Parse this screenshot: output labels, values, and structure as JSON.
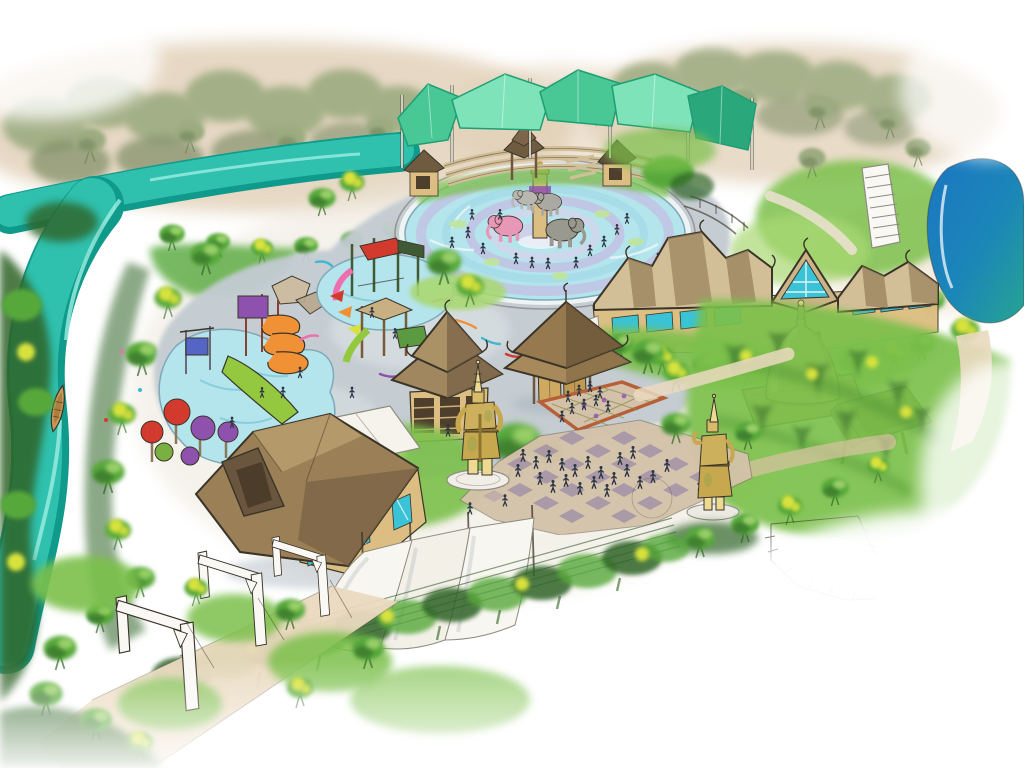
{
  "scene": {
    "kind": "watercolor concept rendering",
    "subject": "Aerial watercolor concept rendering of a Thai-themed elephant water playground park",
    "aria_label": "Hand-drawn aerial watercolor rendering: Thai-themed water playground with elephant splash fountain, shade canopy amphitheater, slide pools, Thai pavilions, golden stupa, two golden guardian statues, checkerboard plaza, lazy river with wooden boat, pond and tree-lined paths"
  },
  "features": {
    "canopy": "teal shade-sail canopy over amphitheater seating",
    "splash_pool": "circular elephant splash fountain pool",
    "kids_pools": "children's splash pools with slides and play structures",
    "river": "lazy river",
    "boat": "wooden boat",
    "pond": "pond",
    "stairs": "hillside staircase",
    "pavilion_small": "small Thai pavilion",
    "pavilion_gate": "Thai gate pavilion",
    "main_building": "main Thai building complex",
    "stupa": "golden stupa shrine",
    "statue_front": "golden yaksha guardian statue (front)",
    "statue_back": "golden yaksha guardian statue (rear)",
    "plaza": "checkerboard plaza with visitors",
    "pergolas": "white gateway pergolas over path",
    "sails": "white shade sails",
    "fence": "vine-covered cable fence",
    "lawn": "terraced lawns with survey marks"
  },
  "palette": {
    "paper": "#ffffff",
    "sand": "#d9c3a3",
    "sand_light": "#ead9bf",
    "deck": "#c2cbd1",
    "deck_light": "#dde3e5",
    "river": "#2fc0ae",
    "river_deep": "#0f9a8b",
    "river_hi": "#9ceee2",
    "pond_blue": "#1b76c2",
    "pond_teal": "#27a492",
    "pool": "#b4e4ec",
    "pool_edge": "#7fa9b8",
    "mandala_lav": "#c9aede",
    "mandala_cyan": "#9fd8e8",
    "lily": "#bfe49a",
    "canopy_a": "#49c795",
    "canopy_b": "#7fe3ba",
    "canopy_c": "#2aa87c",
    "canopy_line": "#1f9e74",
    "roof": "#97805a",
    "roof_dark": "#6f5c40",
    "roof_light": "#c0a678",
    "roof_pale": "#d2bf97",
    "wall": "#dcbe82",
    "wall_dark": "#b08d52",
    "window": "#3ac3d6",
    "gold": "#c7a84f",
    "gold_hi": "#ecd992",
    "gold_mid": "#cdb05c",
    "gold_shadow": "#8f7431",
    "grass": "#7cc04c",
    "grass_light": "#a9d873",
    "grass_dark": "#4c8f31",
    "tree_green": "#57a83b",
    "tree_dark": "#2f6325",
    "tree_muted": "#9cab80",
    "tree_muted_dark": "#72855c",
    "tree_yellow": "#d8e23e",
    "slide_orange": "#f19136",
    "slide_pink": "#ef6fae",
    "slide_purple": "#8e51ad",
    "slide_red": "#d23a2e",
    "slide_green": "#93c83f",
    "bucket_blue": "#5565c6",
    "people": "#2d3442",
    "checker_tan": "#d3c2a9",
    "checker_mauve": "#a391a6",
    "mat_border": "#b75f36",
    "white_struct": "#f9f8f4",
    "struct_line": "#8e8c80",
    "ink": "#3a3428",
    "shadow_blue": "#93a0ae"
  }
}
